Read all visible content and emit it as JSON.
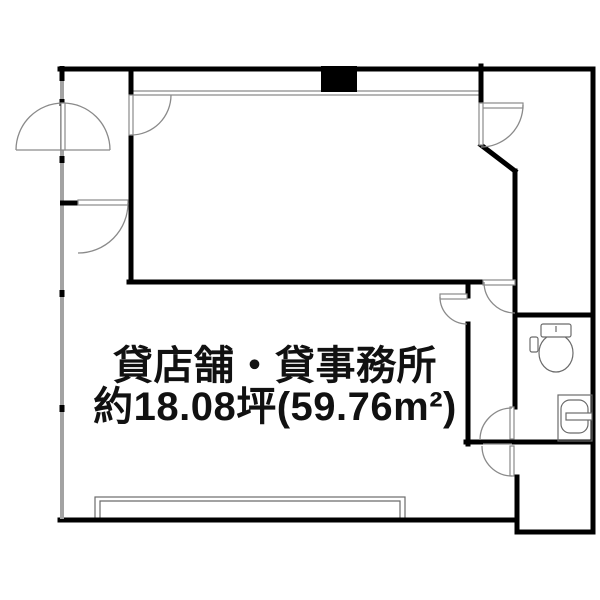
{
  "plan": {
    "room_label": "貸店舗・貸事務所",
    "area_label": "約18.08坪(59.76m²)",
    "colors": {
      "wall": "#000000",
      "lightwall": "#a3a3a3",
      "door": "#8a8a8a",
      "fixture": "#6b6b6b",
      "text": "#111111",
      "bg": "#ffffff"
    }
  }
}
